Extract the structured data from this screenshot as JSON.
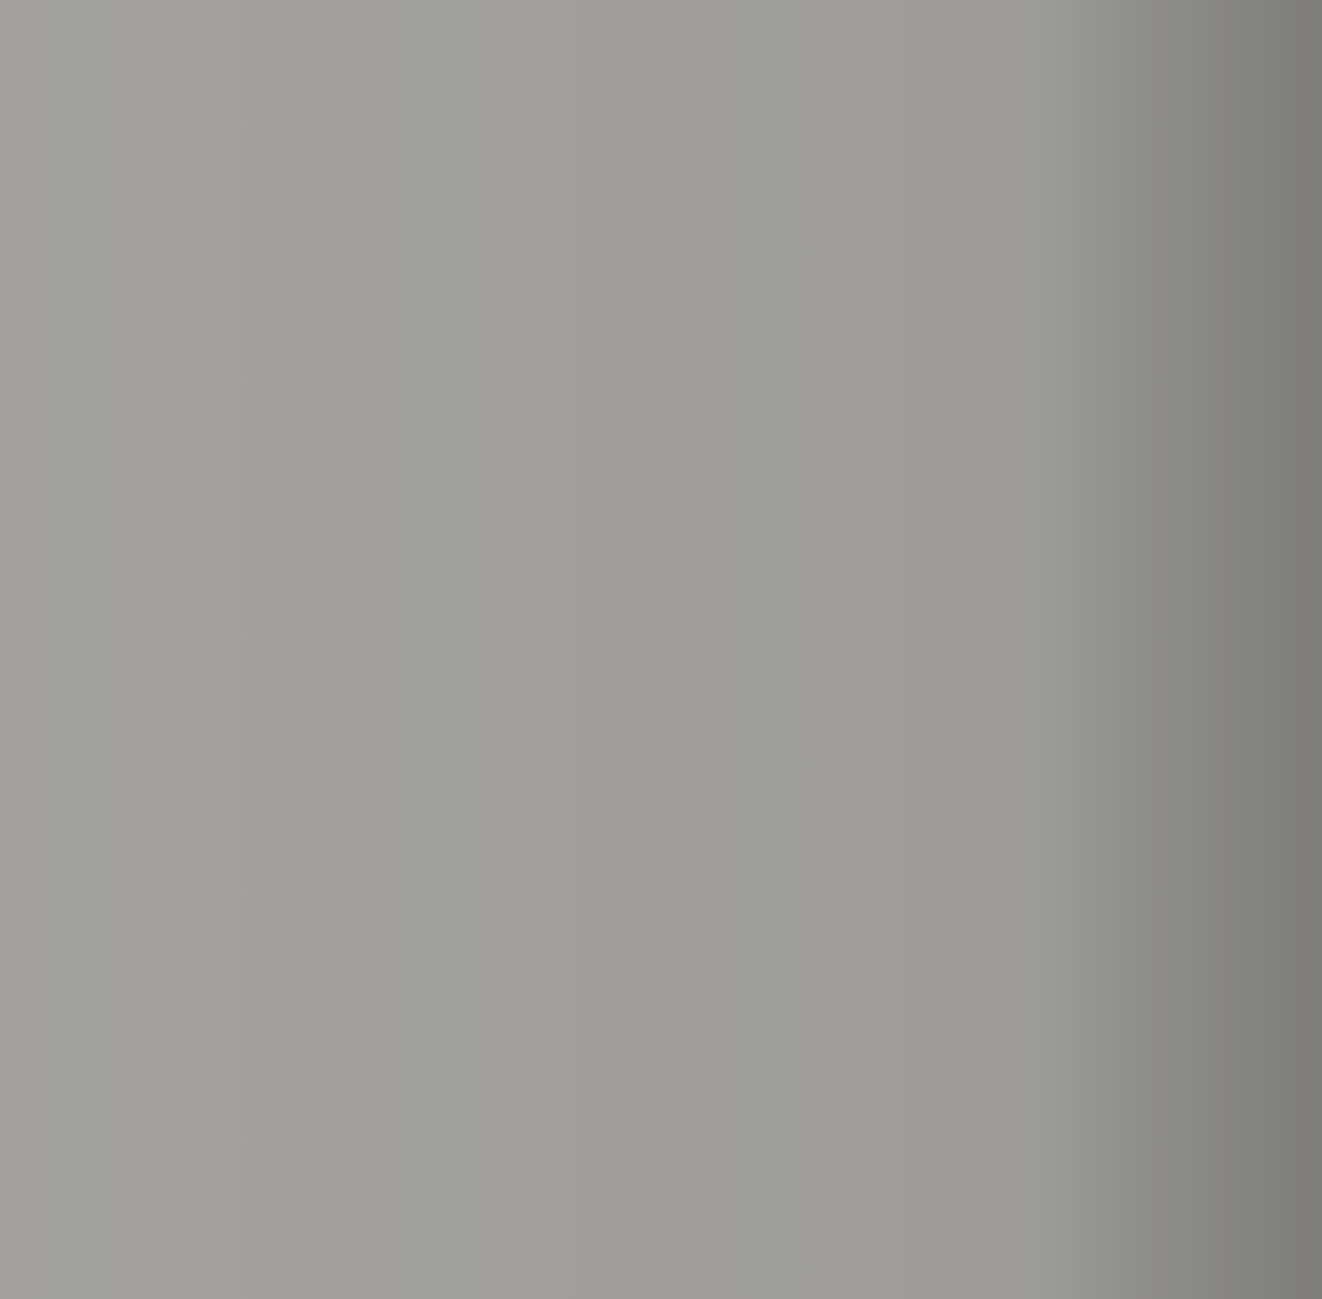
{
  "power_label": "400V ±10%-50Hz-125 Amp",
  "detail_label": "B",
  "soil_note": "THE SOIL",
  "dims": {
    "overall_width": "± 4110",
    "left_offset": "400",
    "top_span": "2625",
    "throat_offset": "1087,5",
    "head_height": "1385",
    "frame_height": "4040",
    "total_height": "4445",
    "stroke": "420",
    "open_height": "820",
    "throat_depth": "405",
    "table_width": "500",
    "table_height": "750",
    "cabinet_floor_gap": "300",
    "pit_depth": "940",
    "slab_thickness": "H",
    "right_depth_1": "1350",
    "right_depth_2": "1650",
    "rod_offset": "130",
    "bolt_span": "1650",
    "rod_span": "475",
    "wall_span": "800",
    "wall_right": "300",
    "wall_left": "300",
    "pit_width": "3500",
    "total_width": "4100"
  },
  "spec_table": {
    "rows": [
      "N",
      "/s",
      "s",
      "n/s",
      "0Hz",
      "-",
      "kg"
    ]
  },
  "border_rows": [
    "1",
    "2",
    "3",
    "4",
    "5",
    "6",
    "7"
  ],
  "colors": {
    "ink": "#2d3039",
    "paper": "#e8e5df",
    "background": "#9c9b97"
  }
}
